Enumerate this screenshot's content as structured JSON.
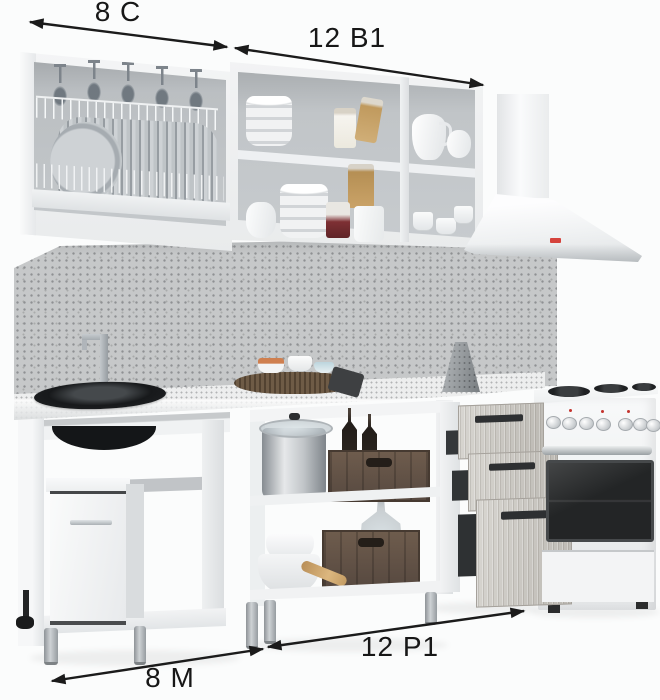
{
  "dimension_labels": {
    "top_left": "8 С",
    "top_right": "12 В1",
    "bottom_left": "8 М",
    "bottom_right": "12 Р1"
  },
  "annotation": {
    "line_color": "#1b1b1b",
    "label_font_px": 28
  },
  "palette": {
    "background": "#fbfcfc",
    "cabinet_white": "#f0f2f3",
    "cabinet_interior_gray": "#c3c7ca",
    "backsplash_speckle": "#c6c8c9",
    "countertop_speckle": "#edeeee",
    "drawer_wood_gray": "#c9c6c1",
    "handle_dark": "#2e3032",
    "sink_black": "#17191b",
    "crate_wood_brown": "#65564a",
    "hood_logo_red": "#d5433c",
    "leg_gray": "#9aa0a4"
  }
}
